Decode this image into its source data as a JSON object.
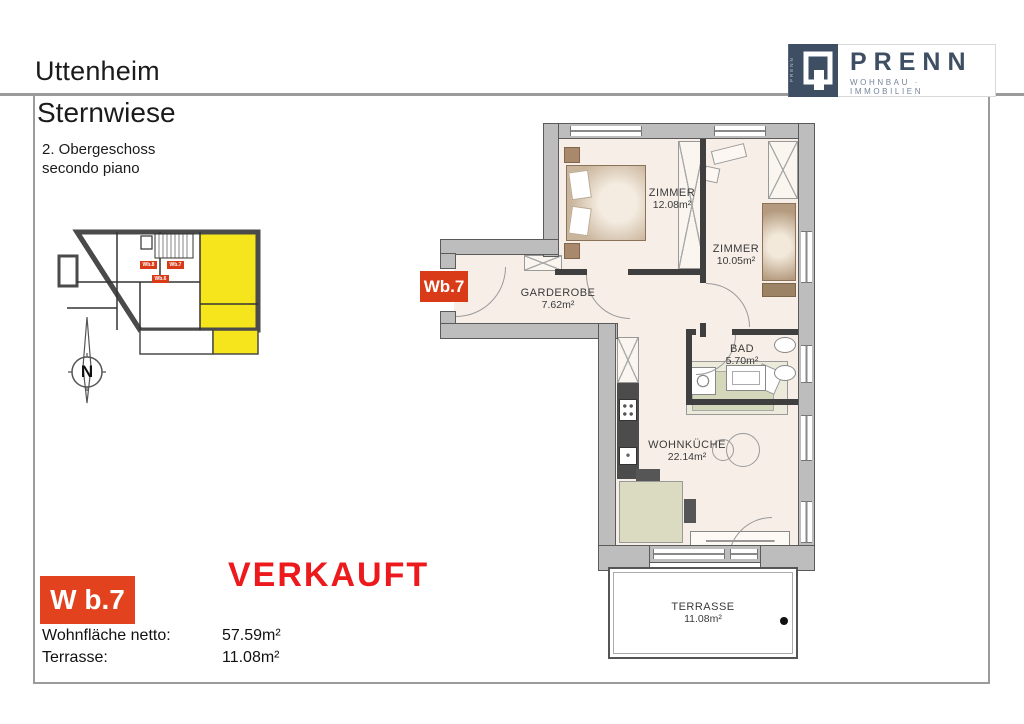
{
  "header": {
    "project": "Uttenheim",
    "subproject": "Sternwiese",
    "floor_de": "2. Obergeschoss",
    "floor_it": "secondo piano"
  },
  "logo": {
    "name": "PRENN",
    "vertical": "PRENN",
    "tagline": "WOHNBAU · IMMOBILIEN",
    "brand_navy": "#3e4e63"
  },
  "overview": {
    "compass": "N",
    "highlight_hex": "#f6e41c",
    "units": [
      {
        "label": "Wb.8"
      },
      {
        "label": "Wb.7"
      },
      {
        "label": "Wb.6"
      }
    ]
  },
  "plan": {
    "unit_tag": "Wb.7",
    "tag_hex": "#d93a17",
    "rooms": [
      {
        "name": "ZIMMER",
        "area": "12.08m²"
      },
      {
        "name": "ZIMMER",
        "area": "10.05m²"
      },
      {
        "name": "GARDEROBE",
        "area": "7.62m²"
      },
      {
        "name": "BAD",
        "area": "5.70m²"
      },
      {
        "name": "WOHNKÜCHE",
        "area": "22.14m²"
      },
      {
        "name": "TERRASSE",
        "area": "11.08m²"
      }
    ]
  },
  "info": {
    "unit": "W b.7",
    "status": "VERKAUFT",
    "status_hex": "#ec1a1c",
    "rows": [
      {
        "label": "Wohnfläche netto:",
        "value": "57.59m²"
      },
      {
        "label": "Terrasse:",
        "value": "11.08m²"
      }
    ]
  }
}
